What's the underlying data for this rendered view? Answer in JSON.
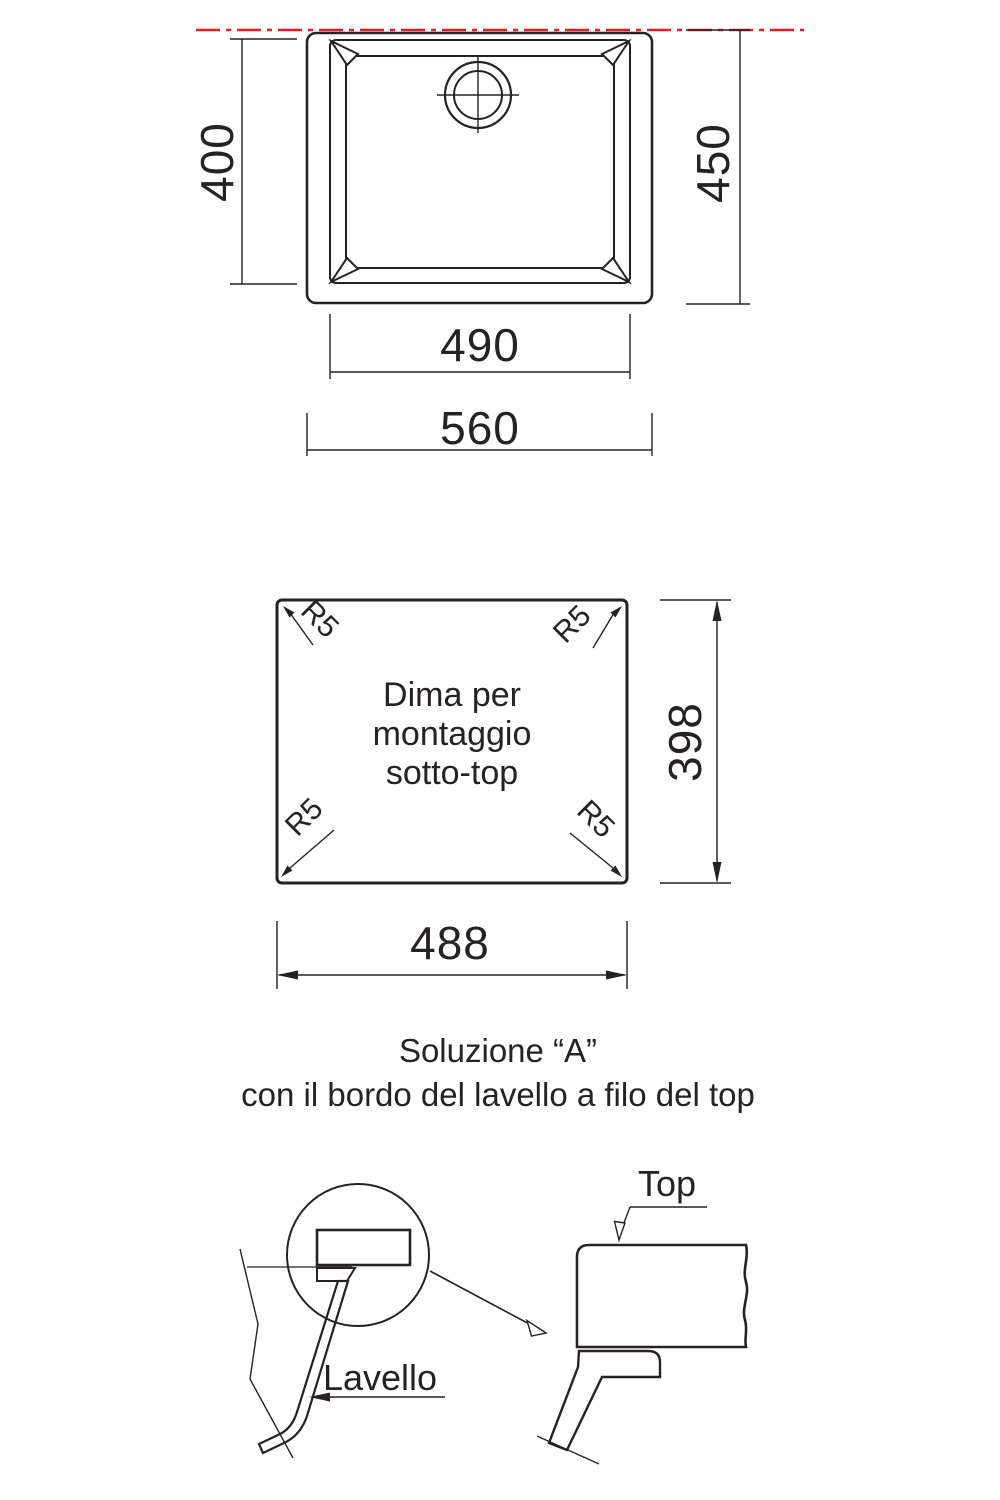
{
  "colors": {
    "line": "#262223",
    "red": "#e51c24"
  },
  "top_view": {
    "dim_rim_height": "400",
    "dim_outer_height": "450",
    "dim_rim_width": "490",
    "dim_outer_width": "560"
  },
  "template_view": {
    "caption_line1": "Dima per",
    "caption_line2": "montaggio",
    "caption_line3": "sotto-top",
    "corner_radius": "R5",
    "dim_height": "398",
    "dim_width": "488"
  },
  "solution": {
    "line1": "Soluzione “A”",
    "line2": "con il bordo del lavello a filo del top"
  },
  "section_details": {
    "countertop_label": "Top",
    "sink_label": "Lavello"
  }
}
